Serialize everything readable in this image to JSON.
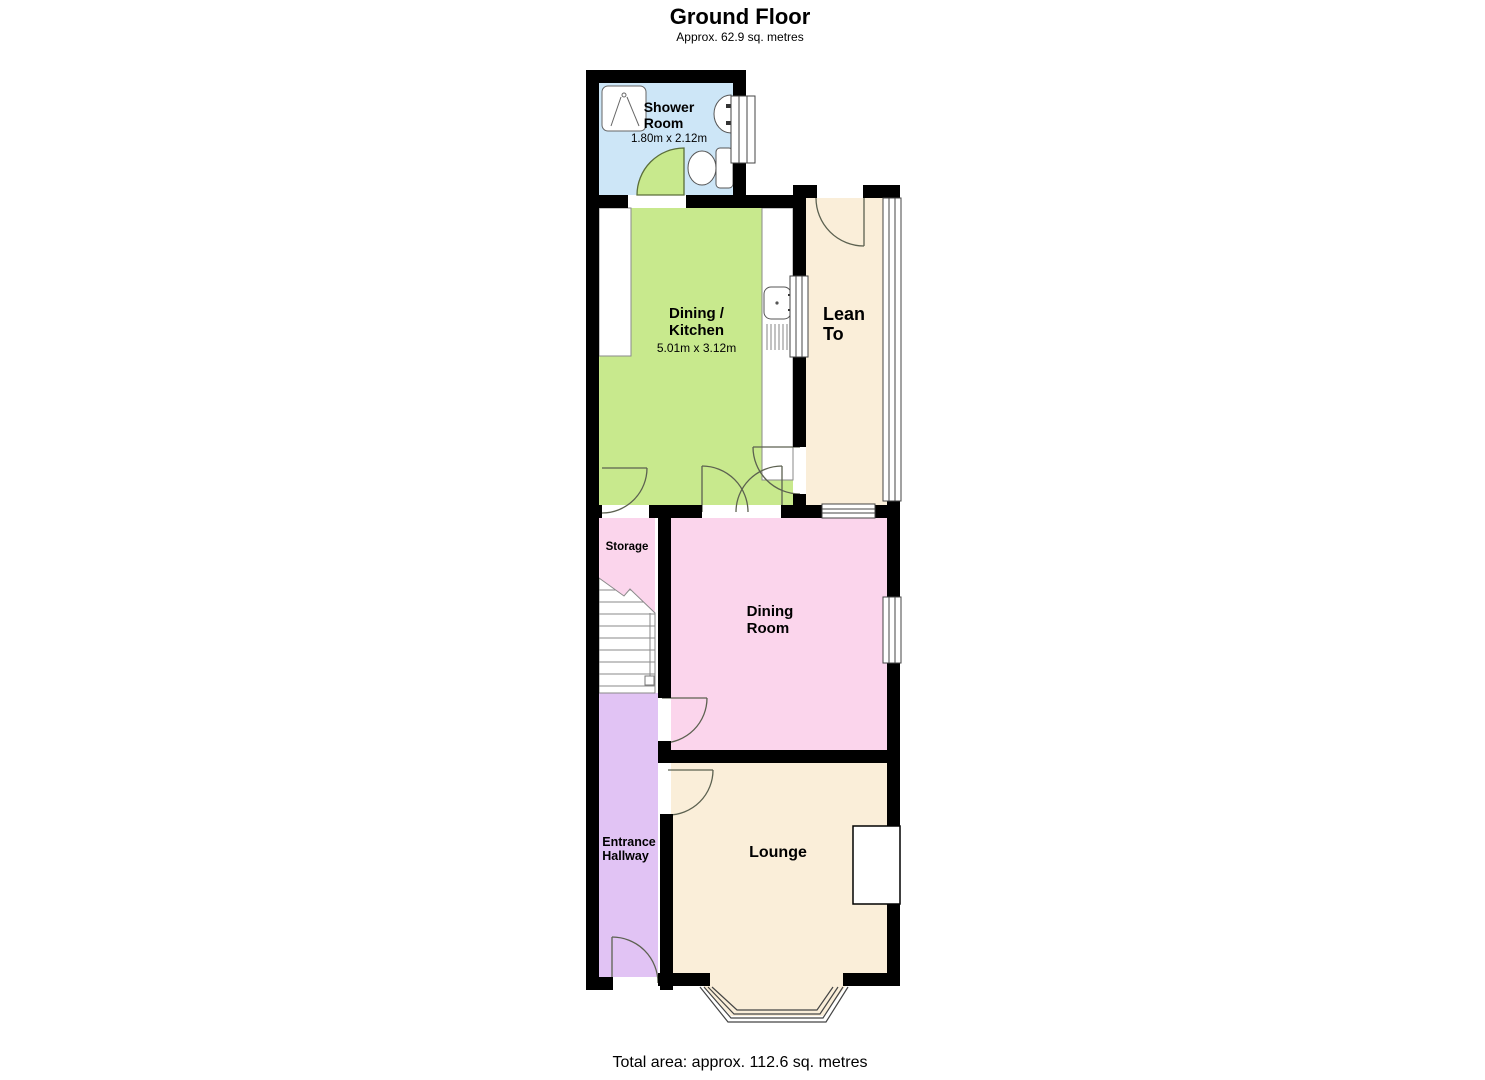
{
  "header": {
    "title": "Ground Floor",
    "subtitle": "Approx. 62.9 sq. metres"
  },
  "footer": {
    "total_area": "Total area: approx. 112.6 sq. metres"
  },
  "colors": {
    "wall": "#000000",
    "shower_room": "#cde6f7",
    "dining_kitchen": "#c8e98d",
    "lean_to": "#faeed9",
    "storage": "#fbd5ec",
    "dining_room": "#fbd5ec",
    "entrance_hallway": "#e1c3f4",
    "lounge": "#faeed9",
    "door_swing": "#c8e98d"
  },
  "rooms": {
    "shower_room": {
      "name": "Shower\nRoom",
      "dimensions": "1.80m x 2.12m"
    },
    "dining_kitchen": {
      "name": "Dining /\nKitchen",
      "dimensions": "5.01m x 3.12m"
    },
    "lean_to": {
      "name": "Lean\nTo"
    },
    "storage": {
      "name": "Storage"
    },
    "dining_room": {
      "name": "Dining\nRoom"
    },
    "entrance_hallway": {
      "name": "Entrance\nHallway"
    },
    "lounge": {
      "name": "Lounge"
    }
  }
}
